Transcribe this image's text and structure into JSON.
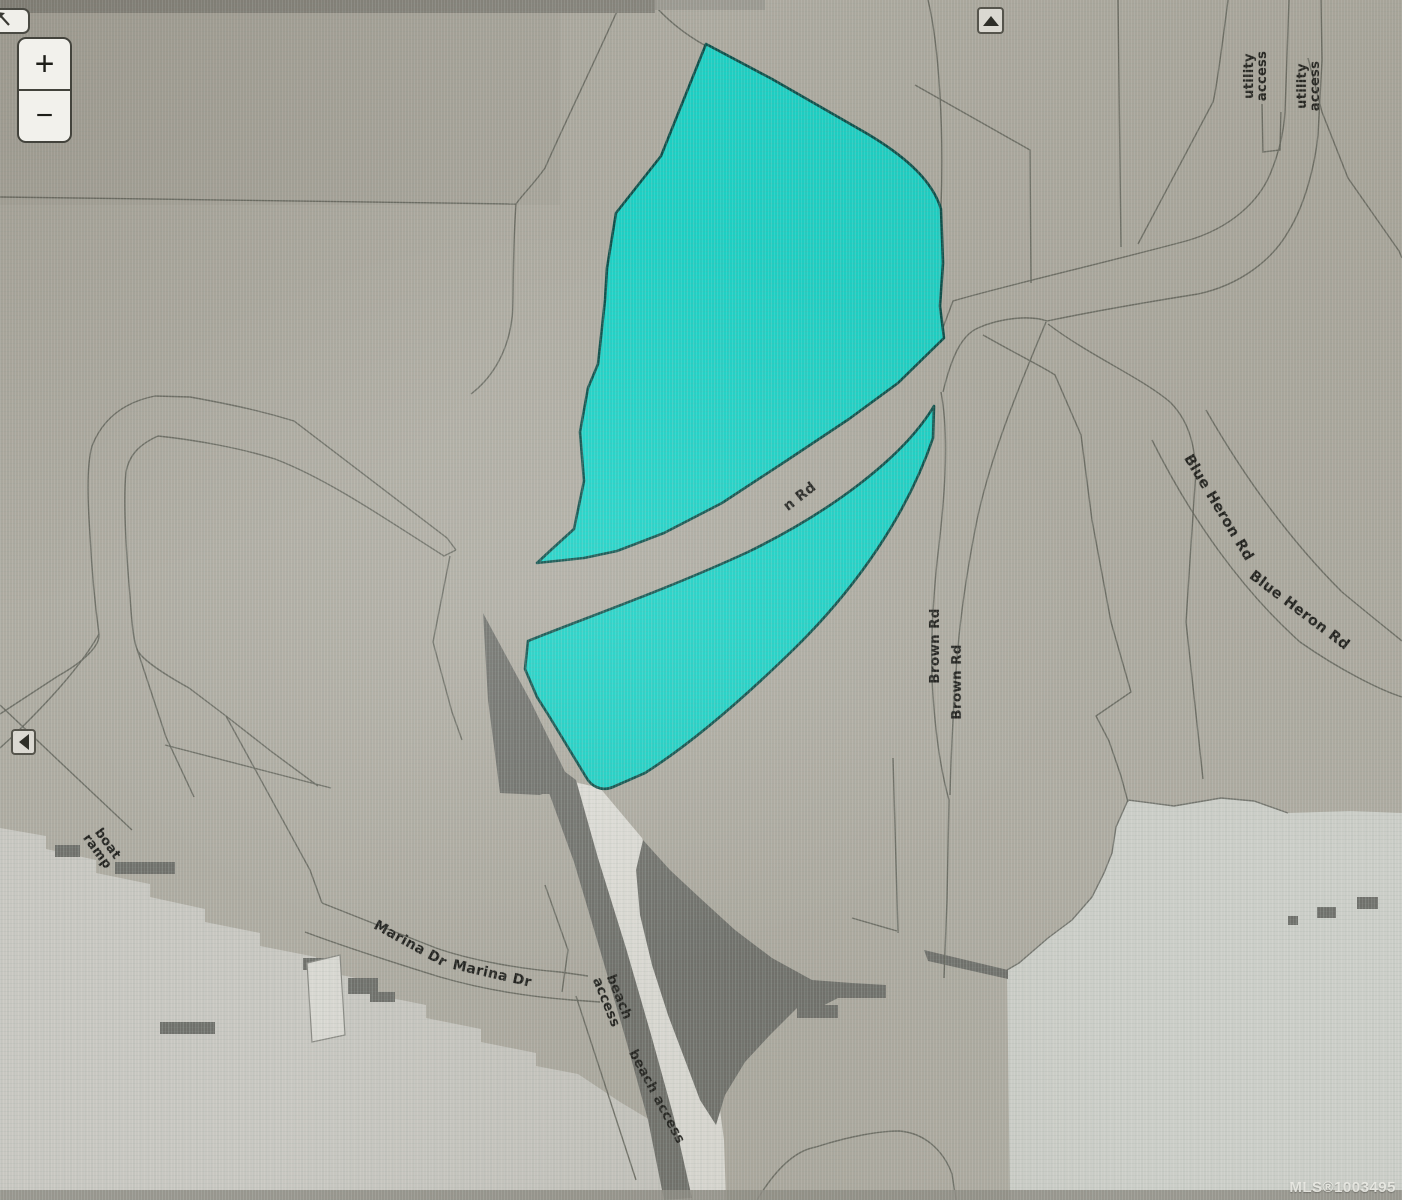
{
  "app": {
    "type": "parcel-map-viewer",
    "watermark": "MLS®1003495"
  },
  "controls": {
    "zoom_in": "+",
    "zoom_out": "−"
  },
  "map_labels": {
    "road_label_partial": "n Rd",
    "brown_rd_1": "Brown Rd",
    "brown_rd_2": "Brown Rd",
    "blue_heron_rd_1": "Blue Heron Rd",
    "blue_heron_rd_2": "Blue Heron Rd",
    "utility_access_1": "utility access",
    "utility_access_2": "utility access",
    "marina_dr_1": "Marina Dr",
    "marina_dr_2": "Marina Dr",
    "boat_ramp": "boat ramp",
    "beach_access_1": "beach access",
    "beach_access_2": "beach access"
  },
  "colors": {
    "highlight_fill": "#1bd2c6",
    "highlight_border": "#0c4f4a",
    "background": "#aeaba1",
    "water": "#c9c8c2",
    "water_right": "#cccec8",
    "shadow_dark": "#6f706b",
    "parcel_line": "#67685f",
    "label_text": "#20201d"
  }
}
